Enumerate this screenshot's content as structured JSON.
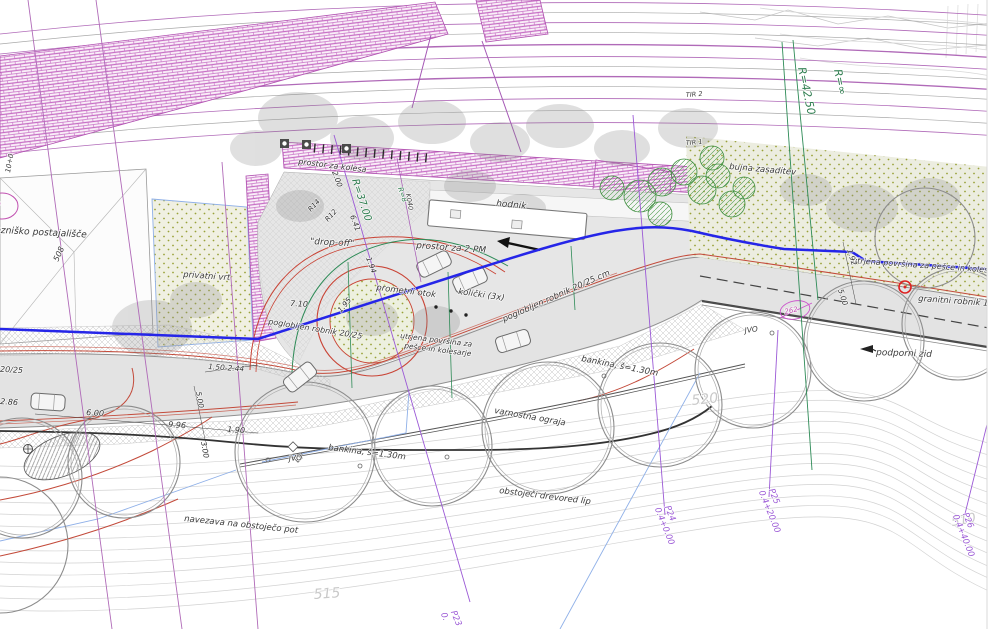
{
  "plan": {
    "labels": {
      "railway_stop": "železniško postajališče",
      "private_garden": "privatni vrt",
      "bike_area": "prostor za kolesa",
      "walkway": "hodnik",
      "drop_off": "\"drop-off\"",
      "parking_2pm": "prostor za 2 PM",
      "traffic_island": "prometni otok",
      "bollards": "količki (3x)",
      "paved_surface_1a": "utrjena površina za",
      "paved_surface_1b": "pešce in kolesarje",
      "lowered_curb_main": "poglobljen robnik 20/25 cm",
      "lowered_curb_mid": "poglobljen robnik 20/25",
      "lowered_curb_left": "poglobljen robnik 20/25",
      "granite_curb": "granitni robnik 15",
      "paved_surface_2": "utrjena površina za pešce in kolesarje",
      "retaining_wall": "podporni zid",
      "lush_planting": "bujna zasaditev",
      "shoulder_1": "bankina, š=1.30m",
      "shoulder_2": "bankina, š=1.30m",
      "safety_fence": "varnostna ograja",
      "tree_row": "obstoječi drevored lip",
      "path_connection": "navezava na obstoječo pot",
      "jvo_1": "JVO",
      "jvo_2": "JVO"
    },
    "tracks": {
      "tir1": "TIR 1",
      "tir2": "TIR 2"
    },
    "radii": {
      "r_inf": "R=∞",
      "r_4250": "R=42.50",
      "r_3700": "R=37.00",
      "r_8": "R=8",
      "r14": "R14",
      "r12": "R12"
    },
    "contours": {
      "c510": "510",
      "c515": "515",
      "c520": "520"
    },
    "sections": {
      "p23": {
        "name": "P23",
        "station": "0."
      },
      "p24": {
        "name": "P24",
        "station": "0.4+0.00"
      },
      "p25": {
        "name": "P25",
        "station": "0.4+20.00"
      },
      "p26": {
        "name": "P26",
        "station": "0.4+40.00"
      }
    },
    "dimensions": {
      "d710": "7.10",
      "d195": "1.95",
      "d641": "6.41",
      "d194": "1.94",
      "d200": "2.00",
      "d600": "6.00",
      "d996": "9.96",
      "d190": "1.90",
      "d286": "2.86",
      "d150_244": "1.50-2.44",
      "d500a": "5.00",
      "d300a": "3.00",
      "d500b": "5.00",
      "d192": "1.92"
    },
    "marks": {
      "parcel_26": "26",
      "parcel_262": "262",
      "m508": "508",
      "chainage": "10+0",
      "k040": "K040"
    },
    "colors": {
      "track_purple": "#b06ab8",
      "curb_red": "#c0392b",
      "intervention_blue": "#2525e8",
      "radius_green": "#2e7d4f",
      "section_purple": "#9b59d6",
      "contour_gray": "#c9c9c9"
    }
  }
}
